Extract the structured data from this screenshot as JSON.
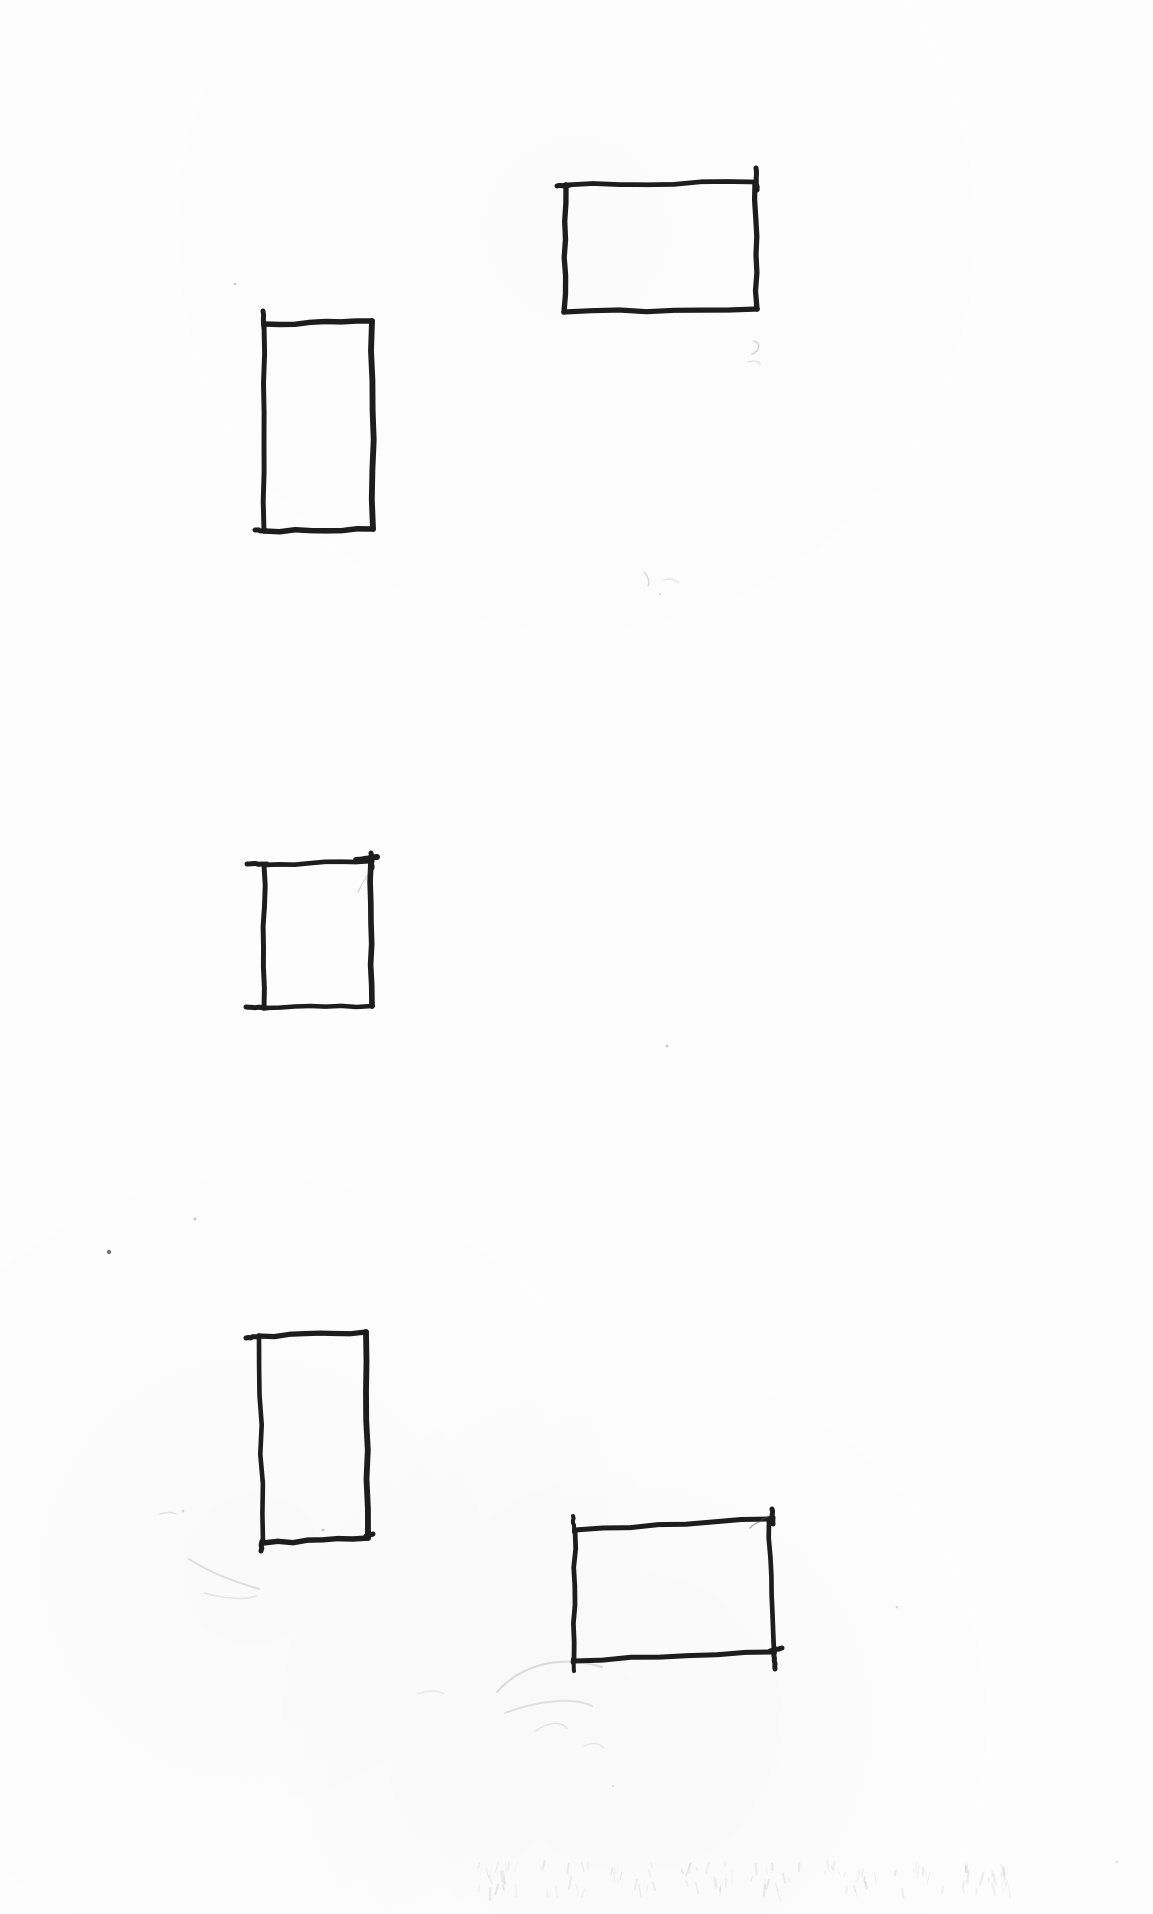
{
  "page": {
    "width": 1153,
    "height": 1914,
    "background": "#fdfdfd",
    "ink_color": "#1d1d1d",
    "pencil_color": "#8f8f8f"
  },
  "sketch": {
    "stroke_width": 5.2,
    "rectangles": [
      {
        "id": "wide-rect-top-right",
        "corners": [
          [
            566,
            185
          ],
          [
            755,
            182
          ],
          [
            757,
            309
          ],
          [
            564,
            312
          ]
        ]
      },
      {
        "id": "tall-rect-upper-left",
        "corners": [
          [
            264,
            324
          ],
          [
            372,
            321
          ],
          [
            373,
            529
          ],
          [
            264,
            531
          ]
        ]
      },
      {
        "id": "square-rect-middle-left",
        "corners": [
          [
            264,
            865
          ],
          [
            371,
            861
          ],
          [
            372,
            1006
          ],
          [
            264,
            1008
          ]
        ]
      },
      {
        "id": "tall-rect-lower-left",
        "corners": [
          [
            259,
            1336
          ],
          [
            366,
            1332
          ],
          [
            368,
            1538
          ],
          [
            263,
            1543
          ]
        ]
      },
      {
        "id": "wide-rect-bottom-right",
        "corners": [
          [
            575,
            1530
          ],
          [
            769,
            1519
          ],
          [
            774,
            1652
          ],
          [
            574,
            1661
          ]
        ]
      }
    ],
    "ticks": [
      {
        "from": [
          756,
          168
        ],
        "to": [
          757,
          190
        ],
        "w": 5
      },
      {
        "from": [
          557,
          186
        ],
        "to": [
          570,
          185
        ],
        "w": 5
      },
      {
        "from": [
          263,
          311
        ],
        "to": [
          264,
          328
        ],
        "w": 5
      },
      {
        "from": [
          255,
          530
        ],
        "to": [
          267,
          531
        ],
        "w": 5
      },
      {
        "from": [
          247,
          864
        ],
        "to": [
          267,
          864
        ],
        "w": 5
      },
      {
        "from": [
          246,
          1007
        ],
        "to": [
          267,
          1008
        ],
        "w": 5
      },
      {
        "from": [
          356,
          860
        ],
        "to": [
          377,
          857
        ],
        "w": 6
      },
      {
        "from": [
          371,
          853
        ],
        "to": [
          372,
          868
        ],
        "w": 5
      },
      {
        "from": [
          246,
          1338
        ],
        "to": [
          262,
          1336
        ],
        "w": 5
      },
      {
        "from": [
          366,
          1536
        ],
        "to": [
          373,
          1534
        ],
        "w": 5
      },
      {
        "from": [
          262,
          1541
        ],
        "to": [
          261,
          1551
        ],
        "w": 5
      },
      {
        "from": [
          772,
          1509
        ],
        "to": [
          773,
          1524
        ],
        "w": 5
      },
      {
        "from": [
          573,
          1516
        ],
        "to": [
          574,
          1532
        ],
        "w": 4
      },
      {
        "from": [
          774,
          1650
        ],
        "to": [
          775,
          1669
        ],
        "w": 5
      },
      {
        "from": [
          573,
          1659
        ],
        "to": [
          574,
          1671
        ],
        "w": 4
      },
      {
        "from": [
          782,
          1648
        ],
        "to": [
          770,
          1651
        ],
        "w": 5
      }
    ],
    "hairlines": [
      {
        "from": [
          768,
          1516
        ],
        "to": [
          750,
          1528
        ],
        "w": 1.5,
        "o": 0.45
      },
      {
        "from": [
          371,
          868
        ],
        "to": [
          358,
          892
        ],
        "w": 1.0,
        "o": 0.3
      }
    ],
    "smudges": [
      {
        "d": "M497,1692 C520,1666 558,1654 602,1667",
        "w": 2.0,
        "o": 0.28
      },
      {
        "d": "M505,1713 C540,1700 574,1697 592,1706",
        "w": 2.0,
        "o": 0.23
      },
      {
        "d": "M536,1731 C548,1722 560,1721 567,1728",
        "w": 1.6,
        "o": 0.2
      },
      {
        "d": "M584,1746 C592,1742 600,1743 604,1748",
        "w": 1.4,
        "o": 0.16
      },
      {
        "d": "M189,1559 C212,1574 236,1582 259,1589",
        "w": 2.0,
        "o": 0.26
      },
      {
        "d": "M204,1593 C226,1599 246,1600 256,1596",
        "w": 1.6,
        "o": 0.2
      },
      {
        "d": "M160,1514 C166,1512 172,1512 176,1514",
        "w": 1.4,
        "o": 0.24
      },
      {
        "d": "M418,1694 C428,1690 438,1690 444,1694",
        "w": 1.4,
        "o": 0.14
      },
      {
        "d": "M754,341 C761,343 760,351 752,354",
        "w": 1.4,
        "o": 0.4
      },
      {
        "d": "M748,362 C754,360 758,361 760,364",
        "w": 1.2,
        "o": 0.28
      },
      {
        "d": "M644,572 C648,576 650,582 648,586",
        "w": 1.4,
        "o": 0.35
      },
      {
        "d": "M664,580 C669,578 675,579 678,583",
        "w": 1.2,
        "o": 0.25
      }
    ],
    "specks": [
      {
        "x": 235,
        "y": 284,
        "r": 1.4,
        "o": 0.28
      },
      {
        "x": 660,
        "y": 594,
        "r": 1.2,
        "o": 0.22
      },
      {
        "x": 667,
        "y": 1046,
        "r": 1.5,
        "o": 0.28
      },
      {
        "x": 109,
        "y": 1252,
        "r": 2.2,
        "o": 0.8
      },
      {
        "x": 195,
        "y": 1219,
        "r": 1.5,
        "o": 0.3
      },
      {
        "x": 323,
        "y": 1530,
        "r": 1.4,
        "o": 0.32
      },
      {
        "x": 183,
        "y": 1511,
        "r": 1.3,
        "o": 0.24
      },
      {
        "x": 897,
        "y": 1607,
        "r": 1.3,
        "o": 0.18
      },
      {
        "x": 613,
        "y": 1786,
        "r": 1.2,
        "o": 0.15
      },
      {
        "x": 1117,
        "y": 1862,
        "r": 1.3,
        "o": 0.18
      }
    ],
    "ghost_band": {
      "x": 470,
      "y": 1852,
      "width": 560,
      "height": 46,
      "marks": 110
    }
  }
}
